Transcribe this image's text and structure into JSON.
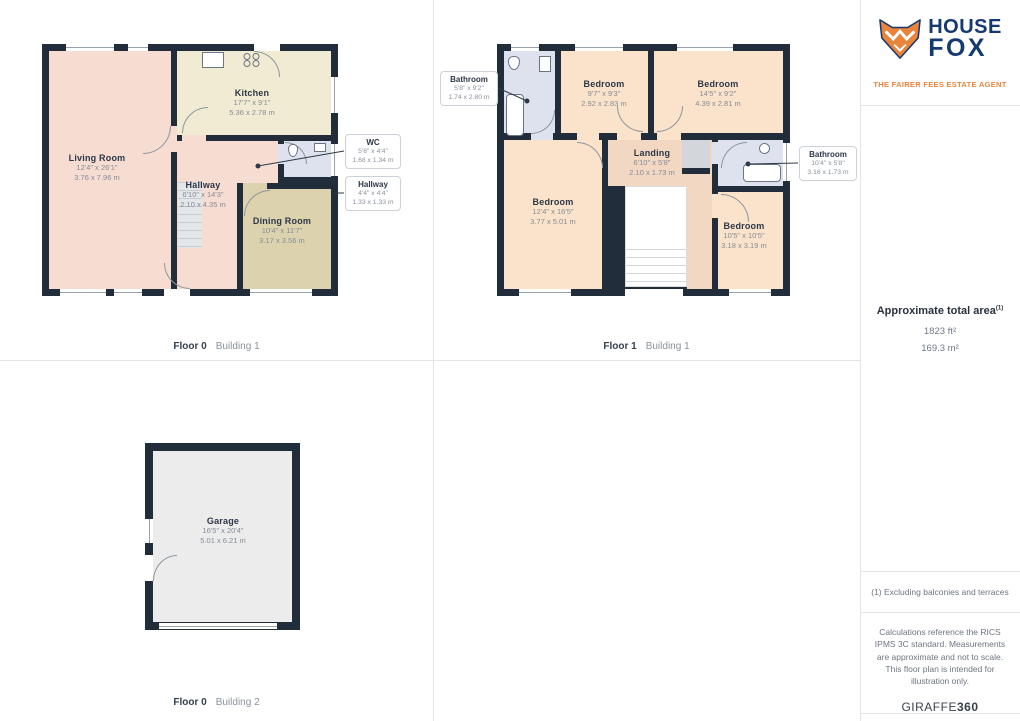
{
  "colors": {
    "wall": "#212d3a",
    "living_hall_fill": "#f6dcd1",
    "kitchen_fill": "#f0ebd2",
    "dining_fill": "#dcd3ae",
    "bath_fill": "#dde2ee",
    "bedroom_fill": "#fbe2ca",
    "landing_fill": "#f2d7c3",
    "garage_fill": "#ececec",
    "brand_navy": "#163a70",
    "brand_orange": "#e8843c"
  },
  "branding": {
    "name_line1": "HOUSE",
    "name_line2": "FOX",
    "tagline": "THE FAIRER FEES ESTATE AGENT"
  },
  "summary": {
    "title": "Approximate total area",
    "superscript": "(1)",
    "area_ft": "1823 ft²",
    "area_m": "169.3 m²"
  },
  "footnotes": {
    "note1": "(1) Excluding balconies and terraces",
    "note2": "Calculations reference the RICS IPMS 3C standard. Measurements are approximate and not to scale. This floor plan is intended for illustration only.",
    "brand_regular": "GIRAFFE",
    "brand_bold": "360"
  },
  "floor0b1": {
    "floor_label": "Floor 0",
    "building_label": "Building 1",
    "rooms": {
      "living": {
        "name": "Living Room",
        "dims_ft": "12'4\" x 26'1\"",
        "dims_m": "3.76 x 7.96 m"
      },
      "kitchen": {
        "name": "Kitchen",
        "dims_ft": "17'7\" x 9'1\"",
        "dims_m": "5.36 x 2.78 m"
      },
      "hallway": {
        "name": "Hallway",
        "dims_ft": "6'10\" x 14'3\"",
        "dims_m": "2.10 x 4.35 m"
      },
      "dining": {
        "name": "Dining Room",
        "dims_ft": "10'4\" x 11'7\"",
        "dims_m": "3.17 x 3.56 m"
      }
    },
    "callouts": {
      "wc": {
        "name": "WC",
        "dims_ft": "5'6\" x 4'4\"",
        "dims_m": "1.68 x 1.34 m"
      },
      "hallway": {
        "name": "Hallway",
        "dims_ft": "4'4\" x 4'4\"",
        "dims_m": "1.33 x 1.33 m"
      }
    }
  },
  "floor1b1": {
    "floor_label": "Floor 1",
    "building_label": "Building 1",
    "rooms": {
      "bedroom_top_mid": {
        "name": "Bedroom",
        "dims_ft": "9'7\" x 9'3\"",
        "dims_m": "2.92 x 2.83 m"
      },
      "bedroom_top_right": {
        "name": "Bedroom",
        "dims_ft": "14'5\" x 9'2\"",
        "dims_m": "4.39 x 2.81 m"
      },
      "landing": {
        "name": "Landing",
        "dims_ft": "6'10\" x 5'8\"",
        "dims_m": "2.10 x 1.73 m"
      },
      "bedroom_left": {
        "name": "Bedroom",
        "dims_ft": "12'4\" x 16'5\"",
        "dims_m": "3.77 x 5.01 m"
      },
      "bedroom_bot_right": {
        "name": "Bedroom",
        "dims_ft": "10'5\" x 10'5\"",
        "dims_m": "3.18 x 3.19 m"
      }
    },
    "callouts": {
      "bathroom_left": {
        "name": "Bathroom",
        "dims_ft": "5'8\" x 9'2\"",
        "dims_m": "1.74 x 2.80 m"
      },
      "bathroom_right": {
        "name": "Bathroom",
        "dims_ft": "10'4\" x 5'8\"",
        "dims_m": "3.16 x 1.73 m"
      }
    }
  },
  "floor0b2": {
    "floor_label": "Floor 0",
    "building_label": "Building 2",
    "rooms": {
      "garage": {
        "name": "Garage",
        "dims_ft": "16'5\" x 20'4\"",
        "dims_m": "5.01 x 6.21 m"
      }
    }
  }
}
